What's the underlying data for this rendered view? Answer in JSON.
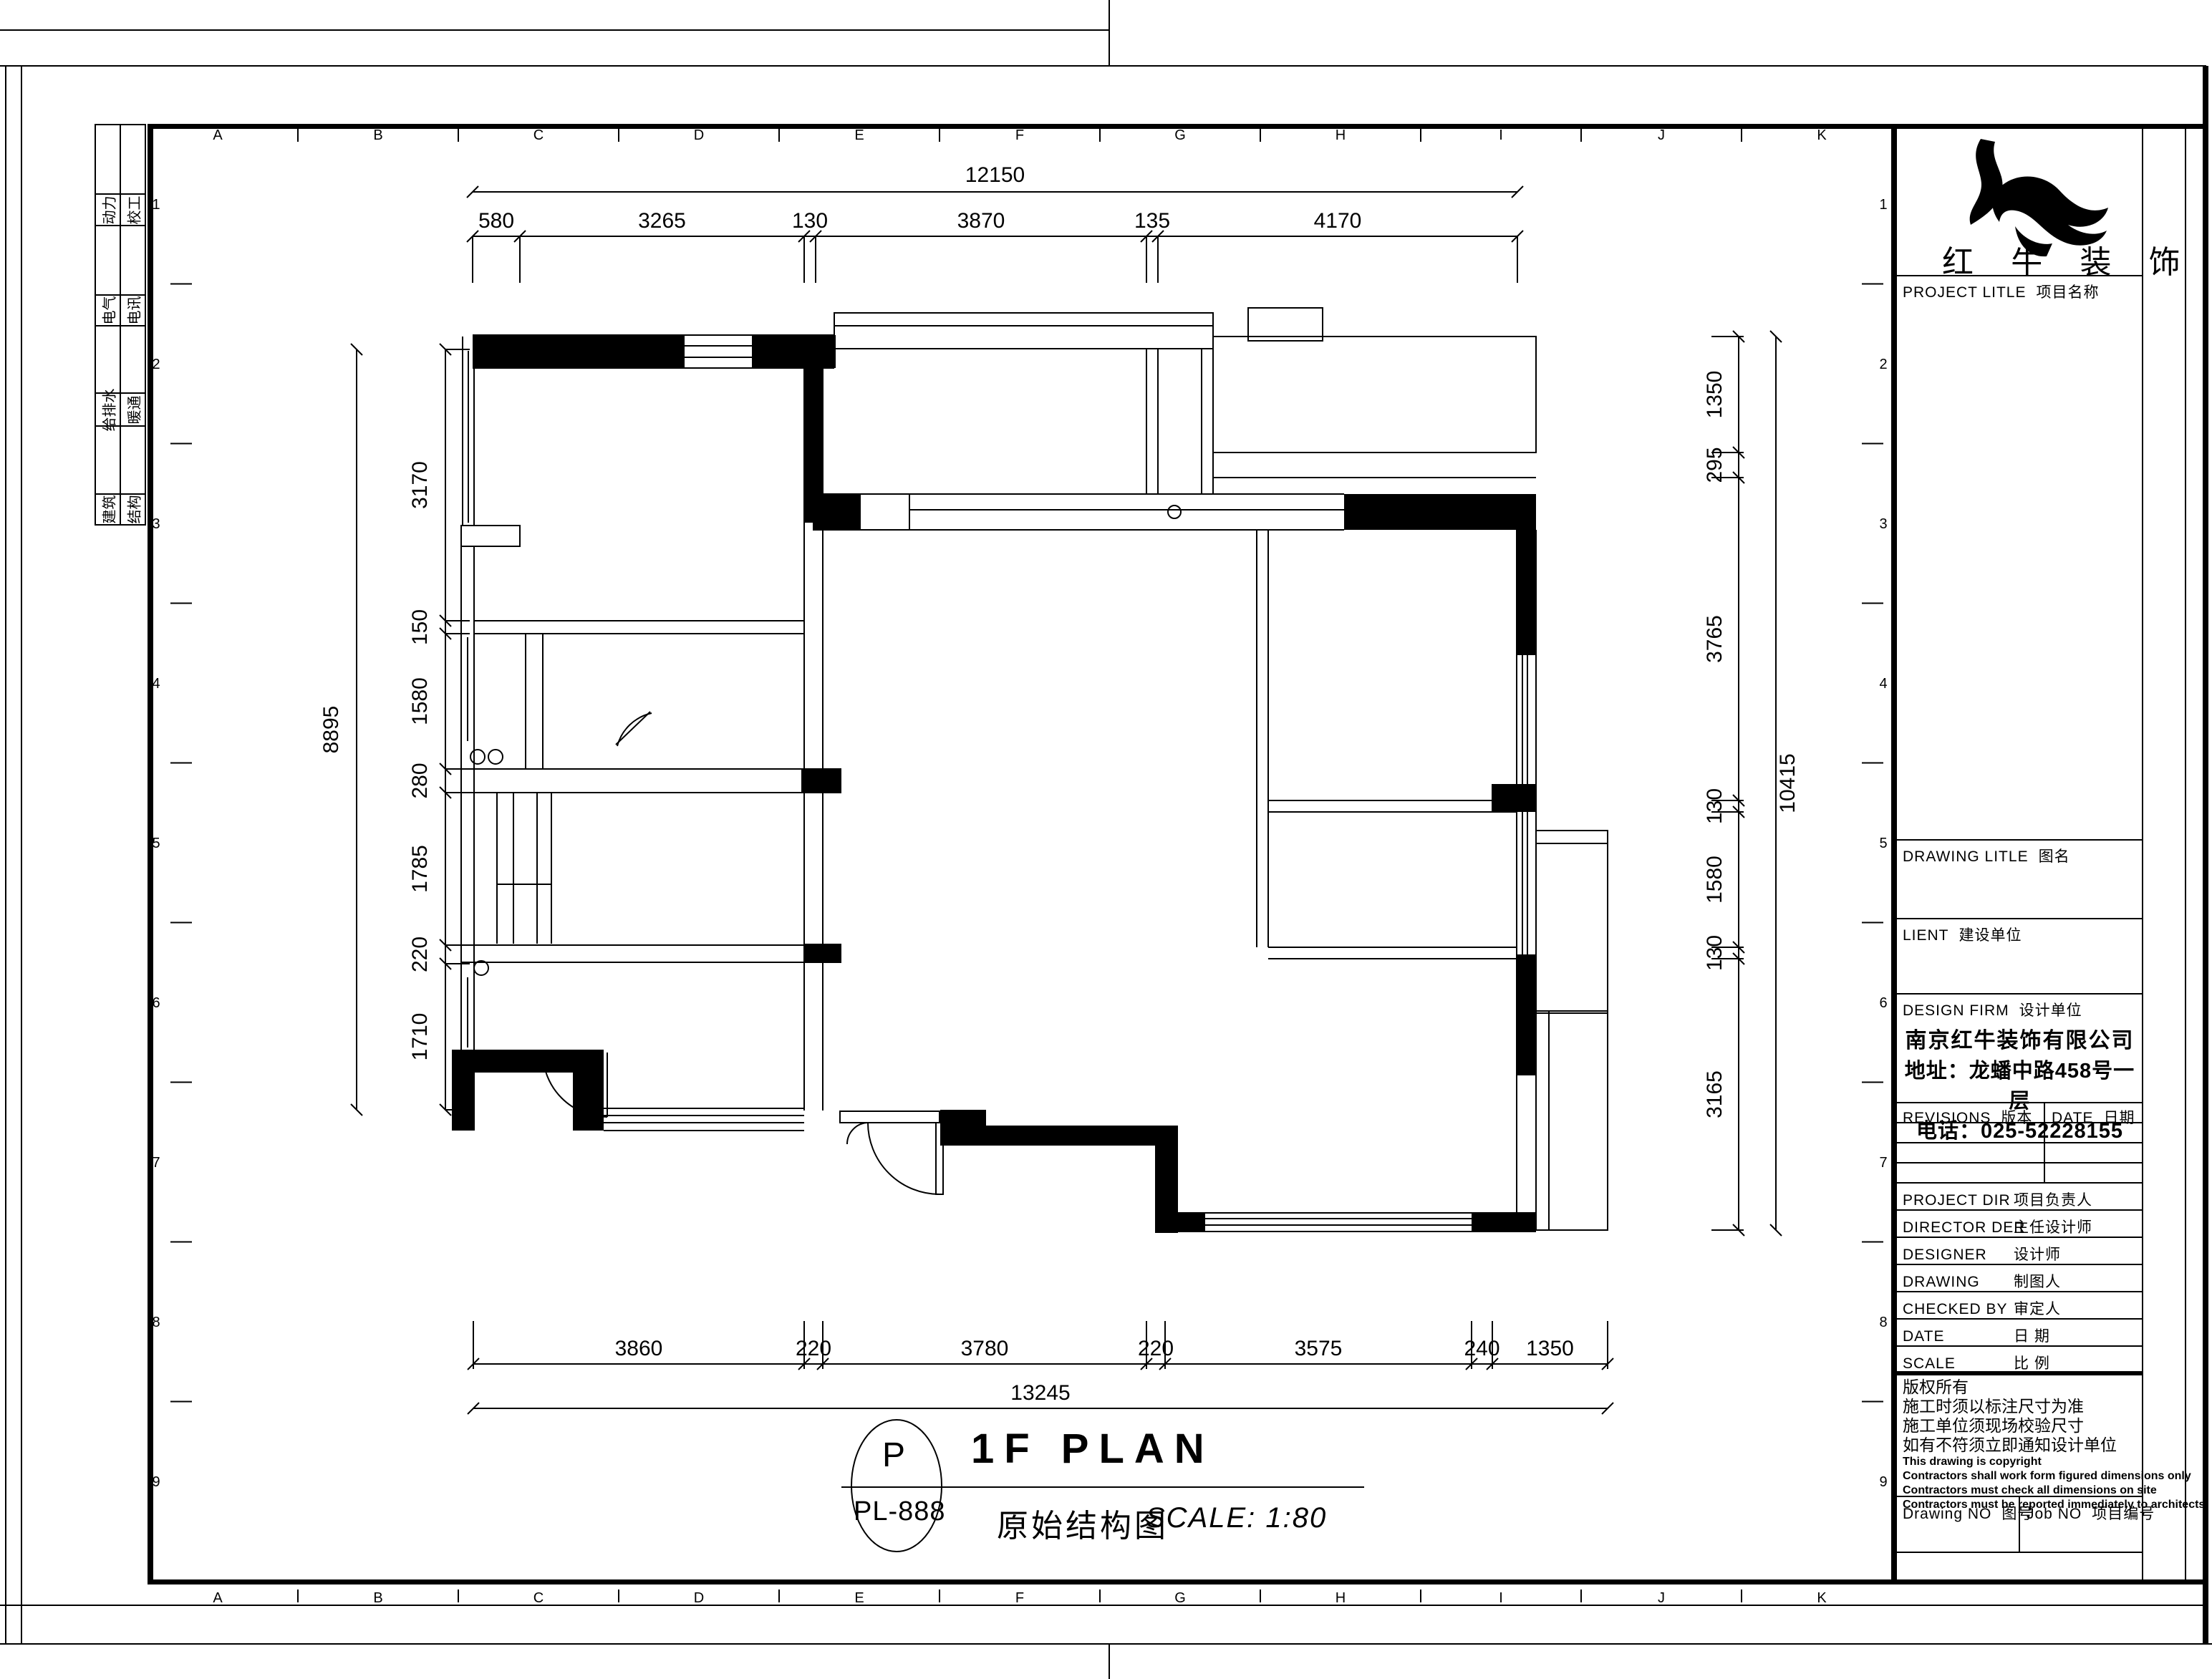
{
  "page": {
    "background": "#ffffff",
    "line_color": "#000000"
  },
  "titles": {
    "plan_title_en": "1F PLAN",
    "plan_title_cn": "原始结构图",
    "scale_label": "SCALE: 1:80",
    "sheet_circle_letter": "P",
    "sheet_circle_code": "PL-888"
  },
  "brand": {
    "logo_text": "红 牛 装 饰"
  },
  "grid": {
    "columns": [
      "A",
      "B",
      "C",
      "D",
      "E",
      "F",
      "G",
      "H",
      "I",
      "J",
      "K"
    ],
    "rows": [
      "1",
      "2",
      "3",
      "4",
      "5",
      "6",
      "7",
      "8",
      "9"
    ]
  },
  "disciplines": [
    {
      "left": "动力",
      "right": "校工"
    },
    {
      "left": "电气",
      "right": "电讯"
    },
    {
      "left": "给排水",
      "right": "暖通"
    },
    {
      "left": "建筑",
      "right": "结构"
    }
  ],
  "dimensions": {
    "top": {
      "overall": "12150",
      "segments": [
        "580",
        "3265",
        "130",
        "3870",
        "135",
        "4170"
      ]
    },
    "bottom": {
      "overall": "13245",
      "segments": [
        "3860",
        "220",
        "3780",
        "220",
        "3575",
        "240",
        "1350"
      ]
    },
    "left": {
      "overall": "8895",
      "segments": [
        "3170",
        "150",
        "1580",
        "280",
        "1785",
        "220",
        "1710"
      ]
    },
    "right": {
      "overall": "10415",
      "segments": [
        "1350",
        "295",
        "3765",
        "130",
        "1580",
        "130",
        "3165"
      ]
    }
  },
  "title_block": {
    "project_title": {
      "en": "PROJECT LITLE",
      "cn": "项目名称"
    },
    "drawing_title": {
      "en": "DRAWING LITLE",
      "cn": "图名"
    },
    "client": {
      "en": "LIENT",
      "cn": "建设单位"
    },
    "design_firm": {
      "en": "DESIGN FIRM",
      "cn": "设计单位"
    },
    "company": {
      "name": "南京红牛装饰有限公司",
      "address": "地址：龙蟠中路458号一层",
      "phone": "电话：025-52228155"
    },
    "revisions": {
      "en": "REVISIONS",
      "cn": "版本"
    },
    "date_col": {
      "en": "DATE",
      "cn": "日期"
    },
    "rows": [
      {
        "en": "PROJECT DIR",
        "cn": "项目负责人"
      },
      {
        "en": "DIRECTOR DER",
        "cn": "主任设计师"
      },
      {
        "en": "DESIGNER",
        "cn": "设计师"
      },
      {
        "en": "DRAWING",
        "cn": "制图人"
      },
      {
        "en": "CHECKED BY",
        "cn": "审定人"
      },
      {
        "en": "DATE",
        "cn": "日 期"
      },
      {
        "en": "SCALE",
        "cn": "比 例"
      }
    ],
    "notes_cn": [
      "版权所有",
      "施工时须以标注尺寸为准",
      "施工单位须现场校验尺寸",
      "如有不符须立即通知设计单位"
    ],
    "notes_en": [
      "This drawing is copyright",
      "Contractors shall work form figured dimensions only",
      "Contractors must check all dimensions on site",
      "Contractors must be reported immediately to architects"
    ],
    "drawing_no": {
      "en": "Drawing NO",
      "cn": "图号"
    },
    "job_no": {
      "en": "Job NO",
      "cn": "项目编号"
    }
  }
}
